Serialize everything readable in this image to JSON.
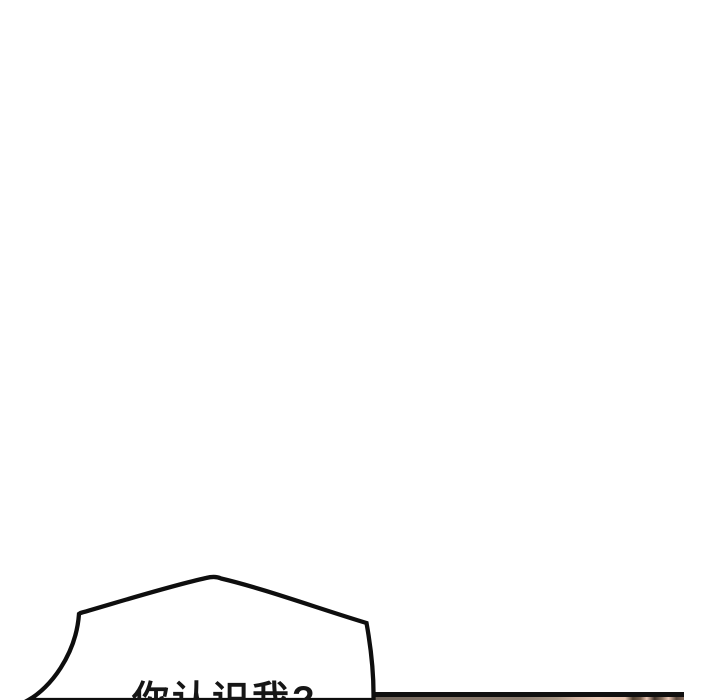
{
  "page": {
    "type": "webtoon-comic-page",
    "background_color": "#ffffff"
  },
  "speech_bubble": {
    "text": "你认识我?",
    "text_color": "#161616",
    "outline_color": "#0e0e0e",
    "fill_color": "#ffffff"
  },
  "next_panel_edge": {
    "border_color": "#101010",
    "art_colors": [
      "#6e635a",
      "#8d7d71",
      "#a99785",
      "#eccab7",
      "#50402f",
      "#84695a"
    ]
  }
}
